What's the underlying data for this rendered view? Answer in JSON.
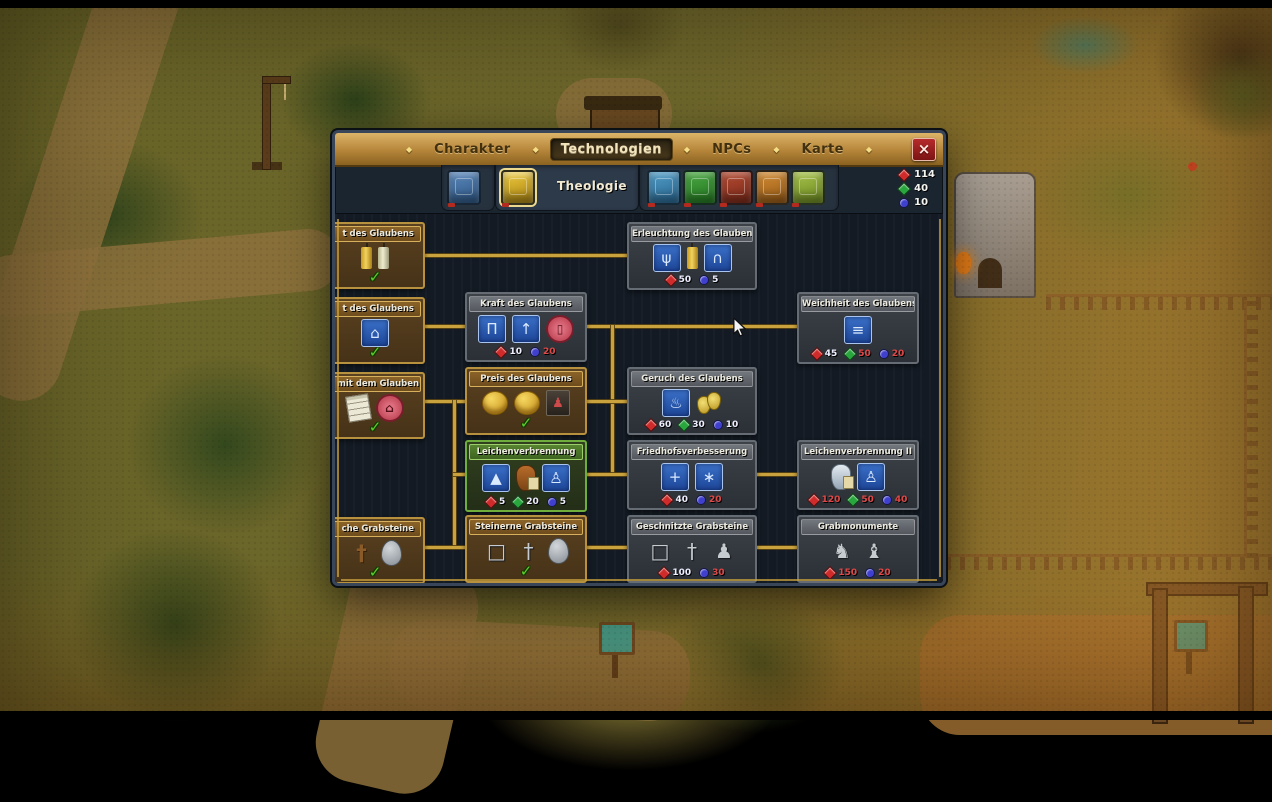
{
  "window": {
    "game": "Graveyard Keeper",
    "close_label": "×"
  },
  "tabs": {
    "items": [
      {
        "label": "Charakter",
        "active": false
      },
      {
        "label": "Technologien",
        "active": true
      },
      {
        "label": "NPCs",
        "active": false
      },
      {
        "label": "Karte",
        "active": false
      }
    ]
  },
  "categories": {
    "selected_label": "Theologie",
    "books": [
      {
        "name": "anatomy",
        "selected": false,
        "c1": "#5a86b8",
        "c2": "#2f5a8a"
      },
      {
        "name": "theology",
        "selected": true,
        "c1": "#ecc93e",
        "c2": "#ad8612"
      },
      {
        "name": "writing",
        "selected": false,
        "c1": "#4f9ac4",
        "c2": "#2a6a96"
      },
      {
        "name": "nature",
        "selected": false,
        "c1": "#4aa642",
        "c2": "#247a22"
      },
      {
        "name": "smithing",
        "selected": false,
        "c1": "#b24a32",
        "c2": "#7e2a1a"
      },
      {
        "name": "building",
        "selected": false,
        "c1": "#d08a34",
        "c2": "#9a5c16"
      },
      {
        "name": "alchemy",
        "selected": false,
        "c1": "#a6c14a",
        "c2": "#6f8c22"
      }
    ]
  },
  "resources": {
    "stock": {
      "r": 114,
      "g": 40,
      "b": 10
    },
    "items": [
      {
        "key": "r",
        "value": "114"
      },
      {
        "key": "g",
        "value": "40"
      },
      {
        "key": "b",
        "value": "10"
      }
    ]
  },
  "tree": {
    "nodes": [
      {
        "id": "candles-of-faith",
        "title": "t des Glaubens",
        "state": "done",
        "x": -10,
        "y": 8,
        "w": 100,
        "h": 67,
        "icons": [
          {
            "k": "candle-gold"
          },
          {
            "k": "candle-pale"
          }
        ],
        "check": true
      },
      {
        "id": "church-of-faith",
        "title": "t des Glaubens",
        "state": "done",
        "x": -10,
        "y": 83,
        "w": 100,
        "h": 67,
        "icons": [
          {
            "k": "blue",
            "g": "⌂"
          }
        ],
        "check": true
      },
      {
        "id": "work-with-faith",
        "title": "t mit dem Glauben",
        "state": "done",
        "x": -10,
        "y": 158,
        "w": 100,
        "h": 67,
        "icons": [
          {
            "k": "scroll"
          },
          {
            "k": "pinkc",
            "g": "⌂"
          }
        ],
        "check": true
      },
      {
        "id": "simple-gravestones",
        "title": "che Grabsteine",
        "state": "done",
        "x": -10,
        "y": 303,
        "w": 100,
        "h": 67,
        "icons": [
          {
            "k": "woodcross",
            "g": "†"
          },
          {
            "k": "stoneoval"
          }
        ],
        "check": true
      },
      {
        "id": "kraft-des-glaubens",
        "title": "Kraft des Glaubens",
        "state": "locked",
        "x": 130,
        "y": 78,
        "w": 122,
        "h": 70,
        "icons": [
          {
            "k": "blue",
            "g": "Π"
          },
          {
            "k": "blue",
            "g": "↑"
          },
          {
            "k": "pinkc",
            "g": "▯"
          }
        ],
        "costs": [
          {
            "c": "r",
            "v": 10
          },
          {
            "c": "b",
            "v": 20
          }
        ]
      },
      {
        "id": "preis-des-glaubens",
        "title": "Preis des Glaubens",
        "state": "done",
        "x": 130,
        "y": 153,
        "w": 122,
        "h": 68,
        "icons": [
          {
            "k": "coin"
          },
          {
            "k": "coin"
          },
          {
            "k": "donation",
            "g": "♟"
          }
        ],
        "check": true
      },
      {
        "id": "leichenverbrennung",
        "title": "Leichenverbrennung",
        "state": "avail",
        "x": 130,
        "y": 226,
        "w": 122,
        "h": 72,
        "icons": [
          {
            "k": "blue",
            "g": "▲"
          },
          {
            "k": "urn-brown"
          },
          {
            "k": "blue",
            "g": "♙"
          }
        ],
        "costs": [
          {
            "c": "r",
            "v": 5
          },
          {
            "c": "g",
            "v": 20
          },
          {
            "c": "b",
            "v": 5
          }
        ]
      },
      {
        "id": "steinerne-grabsteine",
        "title": "Steinerne Grabsteine",
        "state": "done",
        "x": 130,
        "y": 301,
        "w": 122,
        "h": 68,
        "icons": [
          {
            "k": "stone",
            "g": "□"
          },
          {
            "k": "stone",
            "g": "†"
          },
          {
            "k": "stoneoval"
          }
        ],
        "check": true
      },
      {
        "id": "erleuchtung-des-glaubens",
        "title": "Erleuchtung des Glaubens",
        "state": "locked",
        "x": 292,
        "y": 8,
        "w": 130,
        "h": 68,
        "icons": [
          {
            "k": "blue",
            "g": "ψ"
          },
          {
            "k": "candle-gold"
          },
          {
            "k": "blue",
            "g": "∩"
          }
        ],
        "costs": [
          {
            "c": "r",
            "v": 50
          },
          {
            "c": "b",
            "v": 5
          }
        ]
      },
      {
        "id": "geruch-des-glaubens",
        "title": "Geruch des Glaubens",
        "state": "locked",
        "x": 292,
        "y": 153,
        "w": 130,
        "h": 68,
        "icons": [
          {
            "k": "blue",
            "g": "♨"
          },
          {
            "k": "bells"
          }
        ],
        "costs": [
          {
            "c": "r",
            "v": 60
          },
          {
            "c": "g",
            "v": 30
          },
          {
            "c": "b",
            "v": 10
          }
        ]
      },
      {
        "id": "friedhofsverbesserung",
        "title": "Friedhofsverbesserung",
        "state": "locked",
        "x": 292,
        "y": 226,
        "w": 130,
        "h": 70,
        "icons": [
          {
            "k": "blue",
            "g": "+"
          },
          {
            "k": "blue",
            "g": "∗"
          }
        ],
        "costs": [
          {
            "c": "r",
            "v": 40
          },
          {
            "c": "b",
            "v": 20
          }
        ]
      },
      {
        "id": "geschnitzte-grabsteine",
        "title": "Geschnitzte Grabsteine",
        "state": "locked",
        "x": 292,
        "y": 301,
        "w": 130,
        "h": 68,
        "icons": [
          {
            "k": "stone",
            "g": "□"
          },
          {
            "k": "stone",
            "g": "†"
          },
          {
            "k": "stone",
            "g": "♟"
          }
        ],
        "costs": [
          {
            "c": "r",
            "v": 100
          },
          {
            "c": "b",
            "v": 30
          }
        ]
      },
      {
        "id": "weichheit-des-glaubens",
        "title": "Weichheit des Glaubens",
        "state": "locked",
        "x": 462,
        "y": 78,
        "w": 122,
        "h": 72,
        "icons": [
          {
            "k": "blue",
            "g": "≡"
          }
        ],
        "costs": [
          {
            "c": "r",
            "v": 45
          },
          {
            "c": "g",
            "v": 50
          },
          {
            "c": "b",
            "v": 20
          }
        ]
      },
      {
        "id": "leichenverbrennung-2",
        "title": "Leichenverbrennung II",
        "state": "locked",
        "x": 462,
        "y": 226,
        "w": 122,
        "h": 70,
        "icons": [
          {
            "k": "urn-white"
          },
          {
            "k": "blue",
            "g": "♙"
          }
        ],
        "costs": [
          {
            "c": "r",
            "v": 120
          },
          {
            "c": "g",
            "v": 50
          },
          {
            "c": "b",
            "v": 40
          }
        ]
      },
      {
        "id": "grabmonumente",
        "title": "Grabmonumente",
        "state": "locked",
        "x": 462,
        "y": 301,
        "w": 122,
        "h": 68,
        "icons": [
          {
            "k": "stone",
            "g": "♞"
          },
          {
            "k": "stone",
            "g": "♝"
          }
        ],
        "costs": [
          {
            "c": "r",
            "v": 150
          },
          {
            "c": "b",
            "v": 20
          }
        ]
      }
    ],
    "connectors": [
      {
        "x": 90,
        "y": 40,
        "w": 202,
        "h": 3
      },
      {
        "x": 90,
        "y": 111,
        "w": 40,
        "h": 3
      },
      {
        "x": 252,
        "y": 111,
        "w": 210,
        "h": 3
      },
      {
        "x": 276,
        "y": 111,
        "w": 3,
        "h": 150
      },
      {
        "x": 90,
        "y": 186,
        "w": 40,
        "h": 3
      },
      {
        "x": 252,
        "y": 186,
        "w": 40,
        "h": 3
      },
      {
        "x": 118,
        "y": 186,
        "w": 3,
        "h": 148
      },
      {
        "x": 118,
        "y": 259,
        "w": 12,
        "h": 3
      },
      {
        "x": 252,
        "y": 259,
        "w": 40,
        "h": 3
      },
      {
        "x": 422,
        "y": 259,
        "w": 40,
        "h": 3
      },
      {
        "x": 90,
        "y": 332,
        "w": 40,
        "h": 3
      },
      {
        "x": 252,
        "y": 332,
        "w": 40,
        "h": 3
      },
      {
        "x": 422,
        "y": 332,
        "w": 40,
        "h": 3
      }
    ]
  }
}
